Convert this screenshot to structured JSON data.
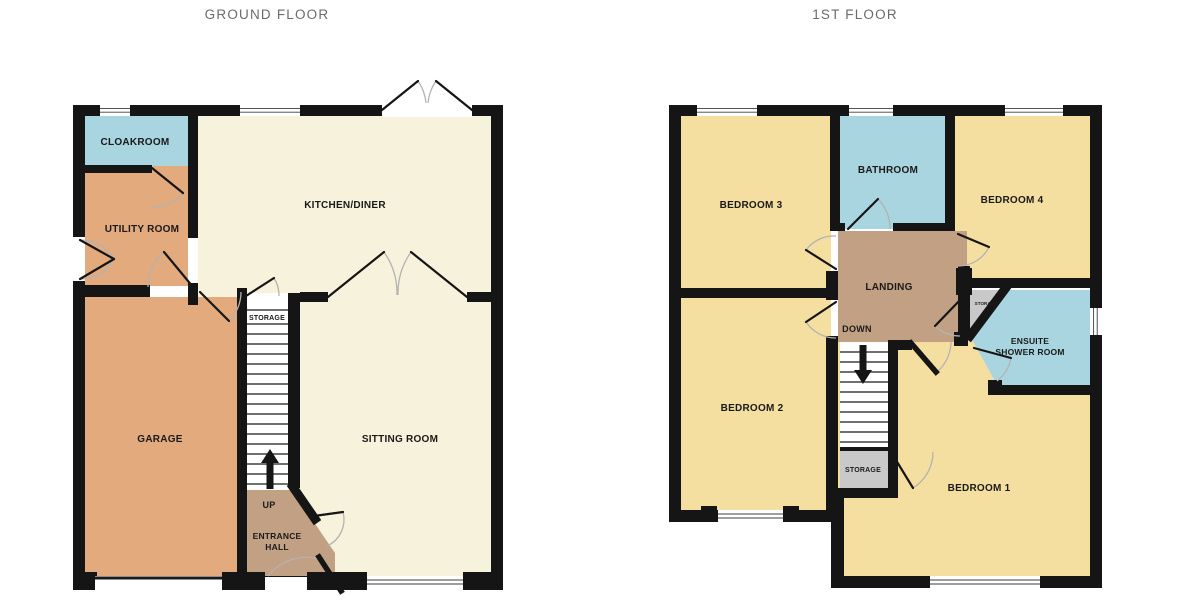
{
  "ground_floor": {
    "title": "GROUND FLOOR",
    "rooms": {
      "cloakroom": "CLOAKROOM",
      "utility": "UTILITY ROOM",
      "kitchen": "KITCHEN/DINER",
      "garage": "GARAGE",
      "sitting": "SITTING ROOM",
      "entrance_line1": "ENTRANCE",
      "entrance_line2": "HALL",
      "stairs_storage": "STORAGE",
      "stairs_direction": "UP"
    }
  },
  "first_floor": {
    "title": "1ST FLOOR",
    "rooms": {
      "bedroom1": "BEDROOM 1",
      "bedroom2": "BEDROOM 2",
      "bedroom3": "BEDROOM 3",
      "bedroom4": "BEDROOM 4",
      "bathroom": "BATHROOM",
      "landing": "LANDING",
      "ensuite_line1": "ENSUITE",
      "ensuite_line2": "SHOWER ROOM",
      "storage_small": "STORAGE",
      "storage_understairs": "STORAGE",
      "stairs_direction": "DOWN"
    }
  },
  "colors": {
    "room_cream": "#F7F2DB",
    "room_orange": "#E3AA7D",
    "room_brown": "#C2A083",
    "room_yellow": "#F4DFA0",
    "room_blue": "#A9D5E0",
    "room_gray": "#C9C9C9",
    "wall": "#151515",
    "title_text": "#6B6B6B",
    "label_text": "#1A1A1A",
    "door_arc": "#B3B3B3"
  }
}
